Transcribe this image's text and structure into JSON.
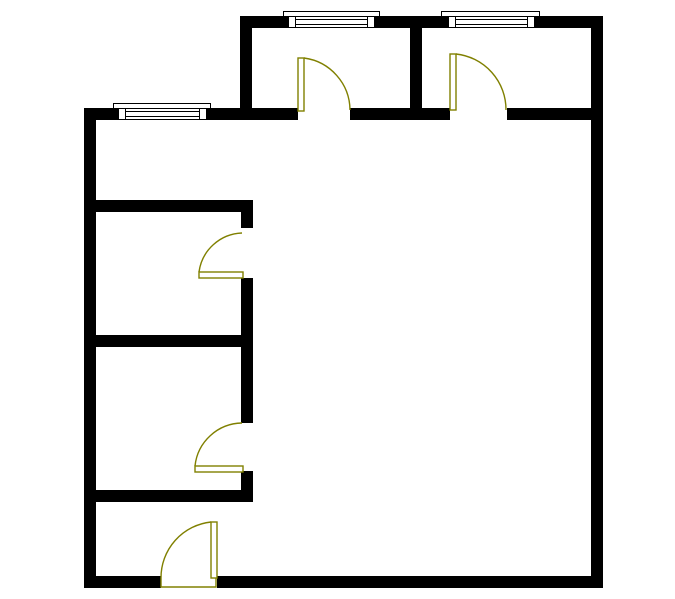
{
  "canvas": {
    "width": 675,
    "height": 599,
    "background": "#ffffff"
  },
  "colors": {
    "wall": "#000000",
    "door": "#808000",
    "window_line": "#000000",
    "window_fill": "#ffffff"
  },
  "plan": {
    "walls": [
      {
        "name": "top-exterior-wall",
        "rect": [
          240,
          16,
          363,
          12
        ]
      },
      {
        "name": "right-exterior-wall",
        "rect": [
          591,
          16,
          12,
          572
        ]
      },
      {
        "name": "bottom-exterior-wall-west",
        "rect": [
          84,
          576,
          77,
          12
        ]
      },
      {
        "name": "bottom-exterior-wall-east",
        "rect": [
          217,
          576,
          386,
          12
        ]
      },
      {
        "name": "left-exterior-wall",
        "rect": [
          84,
          108,
          12,
          480
        ]
      },
      {
        "name": "north-interior-wall-west",
        "rect": [
          84,
          108,
          214,
          12
        ]
      },
      {
        "name": "north-interior-wall-mid",
        "rect": [
          350,
          108,
          100,
          12
        ]
      },
      {
        "name": "north-interior-wall-east",
        "rect": [
          507,
          108,
          84,
          12
        ]
      },
      {
        "name": "extension-west-wall",
        "rect": [
          240,
          16,
          12,
          104
        ]
      },
      {
        "name": "extension-divider-wall",
        "rect": [
          410,
          16,
          12,
          104
        ]
      },
      {
        "name": "left-rooms-wall-1",
        "rect": [
          84,
          200,
          169,
          12
        ]
      },
      {
        "name": "left-rooms-wall-2",
        "rect": [
          84,
          335,
          169,
          12
        ]
      },
      {
        "name": "left-rooms-wall-3",
        "rect": [
          84,
          490,
          169,
          12
        ]
      },
      {
        "name": "corridor-wall-upper",
        "rect": [
          241,
          200,
          12,
          28
        ]
      },
      {
        "name": "corridor-wall-middle",
        "rect": [
          241,
          278,
          12,
          145
        ]
      },
      {
        "name": "corridor-wall-lower",
        "rect": [
          241,
          471,
          12,
          31
        ]
      }
    ],
    "windows": [
      {
        "name": "window-west",
        "frame": [
          113,
          103,
          98,
          6
        ],
        "body": [
          118,
          107,
          89,
          13
        ],
        "posts": [
          [
            118,
            107,
            8,
            13
          ],
          [
            199,
            107,
            8,
            13
          ]
        ],
        "lines": [
          [
            126,
            111,
            73
          ],
          [
            126,
            116,
            73
          ]
        ]
      },
      {
        "name": "window-north-room1",
        "frame": [
          283,
          11,
          97,
          6
        ],
        "body": [
          288,
          15,
          87,
          13
        ],
        "posts": [
          [
            288,
            15,
            8,
            13
          ],
          [
            367,
            15,
            8,
            13
          ]
        ],
        "lines": [
          [
            296,
            19,
            71
          ],
          [
            296,
            24,
            71
          ]
        ]
      },
      {
        "name": "window-north-room2",
        "frame": [
          441,
          11,
          99,
          6
        ],
        "body": [
          448,
          15,
          87,
          13
        ],
        "posts": [
          [
            448,
            15,
            8,
            13
          ],
          [
            527,
            15,
            8,
            13
          ]
        ],
        "lines": [
          [
            456,
            19,
            71
          ],
          [
            456,
            24,
            71
          ]
        ]
      }
    ],
    "doors": [
      {
        "name": "door-top-room-1",
        "panel": [
          298,
          58,
          6,
          53
        ],
        "arc": "M 304 58 A 53 53 0 0 1 350 110"
      },
      {
        "name": "door-top-room-2",
        "panel": [
          450,
          54,
          6,
          56
        ],
        "arc": "M 456 54 A 56 56 0 0 1 506 110"
      },
      {
        "name": "door-left-room-1",
        "panel": [
          199,
          272,
          44,
          6
        ],
        "arc": "M 242 233 A 45 45 0 0 0 199 272"
      },
      {
        "name": "door-left-room-2",
        "panel": [
          195,
          466,
          48,
          6
        ],
        "arc": "M 242 423 A 48 48 0 0 0 195 466"
      },
      {
        "name": "entry-door",
        "panel": [
          211,
          522,
          6,
          56
        ],
        "arc": "M 211 522 A 56 56 0 0 0 161 578",
        "threshold": "M 161 578 L 161 587 L 216 587 L 216 578"
      }
    ]
  }
}
